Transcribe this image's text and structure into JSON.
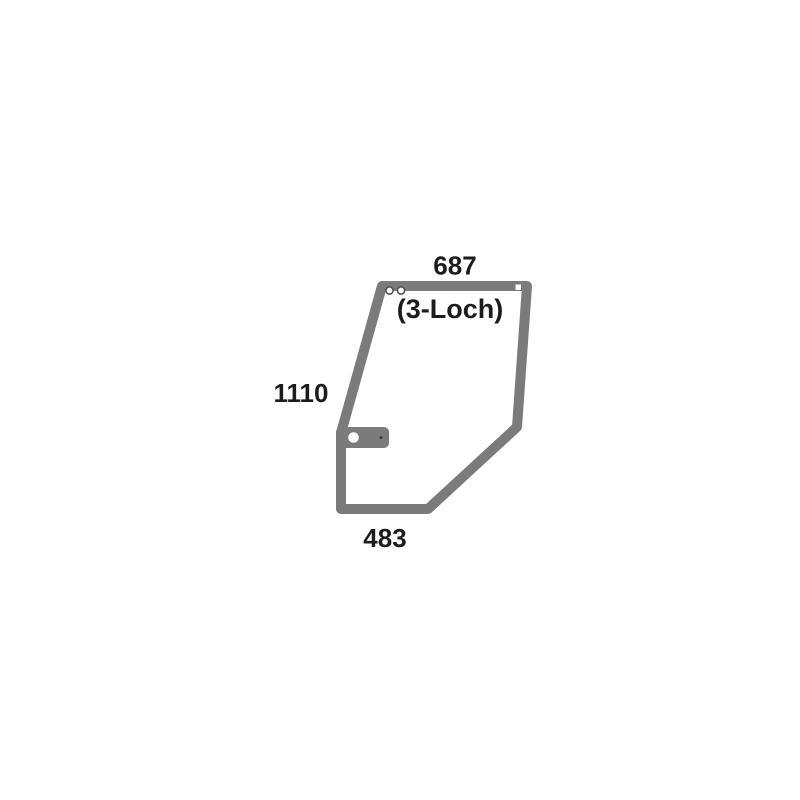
{
  "diagram": {
    "kind": "technical part drawing",
    "subject": "door glass / seal outline with dimensions",
    "dimensions": {
      "top": "687",
      "left": "1110",
      "bottom": "483"
    },
    "note": "(3-Loch)",
    "colors": {
      "outline_gray": "#7b7b7b",
      "label_text": "#1c1c1c",
      "hole_ring": "#4d4d4d",
      "background": "#ffffff"
    }
  }
}
